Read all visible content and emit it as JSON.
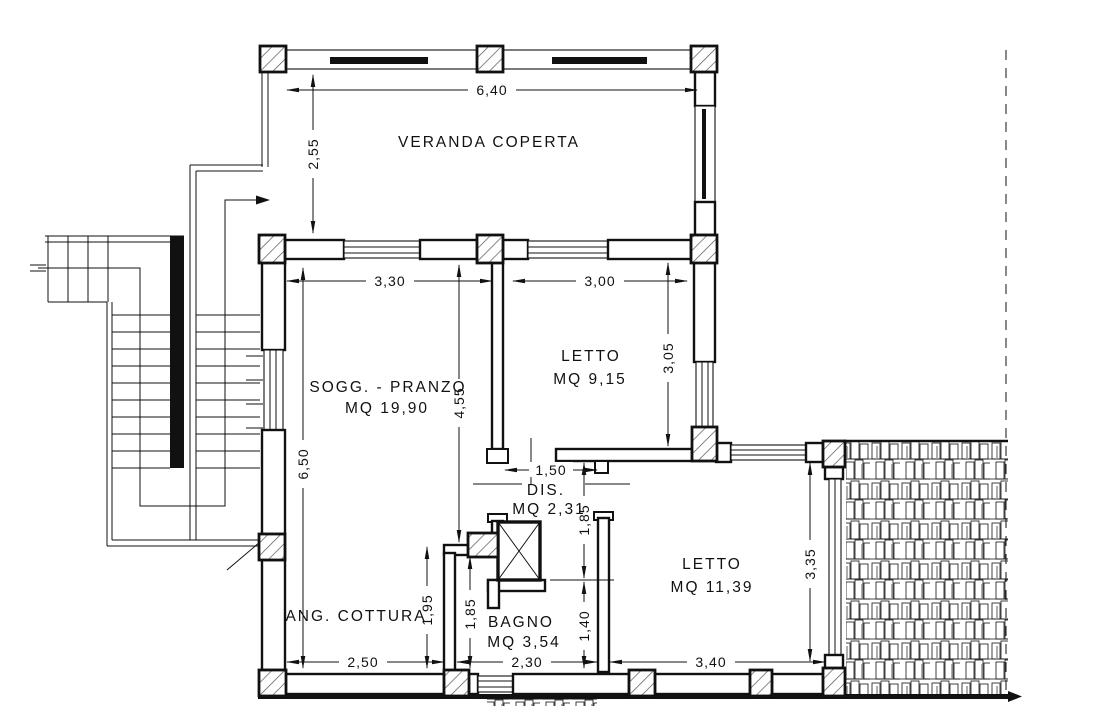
{
  "drawing": {
    "rooms": {
      "veranda": {
        "name": "VERANDA COPERTA"
      },
      "soggiorno": {
        "name": "SOGG. - PRANZO",
        "area": "MQ 19,90"
      },
      "letto1": {
        "name": "LETTO",
        "area": "MQ 9,15"
      },
      "dis": {
        "name": "DIS.",
        "area": "MQ 2,31"
      },
      "letto2": {
        "name": "LETTO",
        "area": "MQ 11,39"
      },
      "bagno": {
        "name": "BAGNO",
        "area": "MQ 3,54"
      },
      "cottura": {
        "name": "ANG. COTTURA"
      }
    },
    "dimensions": {
      "veranda_width": "6,40",
      "veranda_depth": "2,55",
      "sogg_width": "3,30",
      "letto1_width": "3,00",
      "letto1_depth": "3,05",
      "sogg_depth": "4,55",
      "house_depth": "6,50",
      "dis_width": "1,50",
      "dis_depth": "1,85",
      "bagno_door": "1,40",
      "bagno_depth": "1,85",
      "cottura_depth": "1,95",
      "cottura_width": "2,50",
      "bagno_width": "2,30",
      "letto2_width": "3,40",
      "letto2_depth": "3,35"
    },
    "colors": {
      "line": "#111111",
      "background": "#ffffff",
      "tile_accent": "#9a9a9a"
    }
  }
}
